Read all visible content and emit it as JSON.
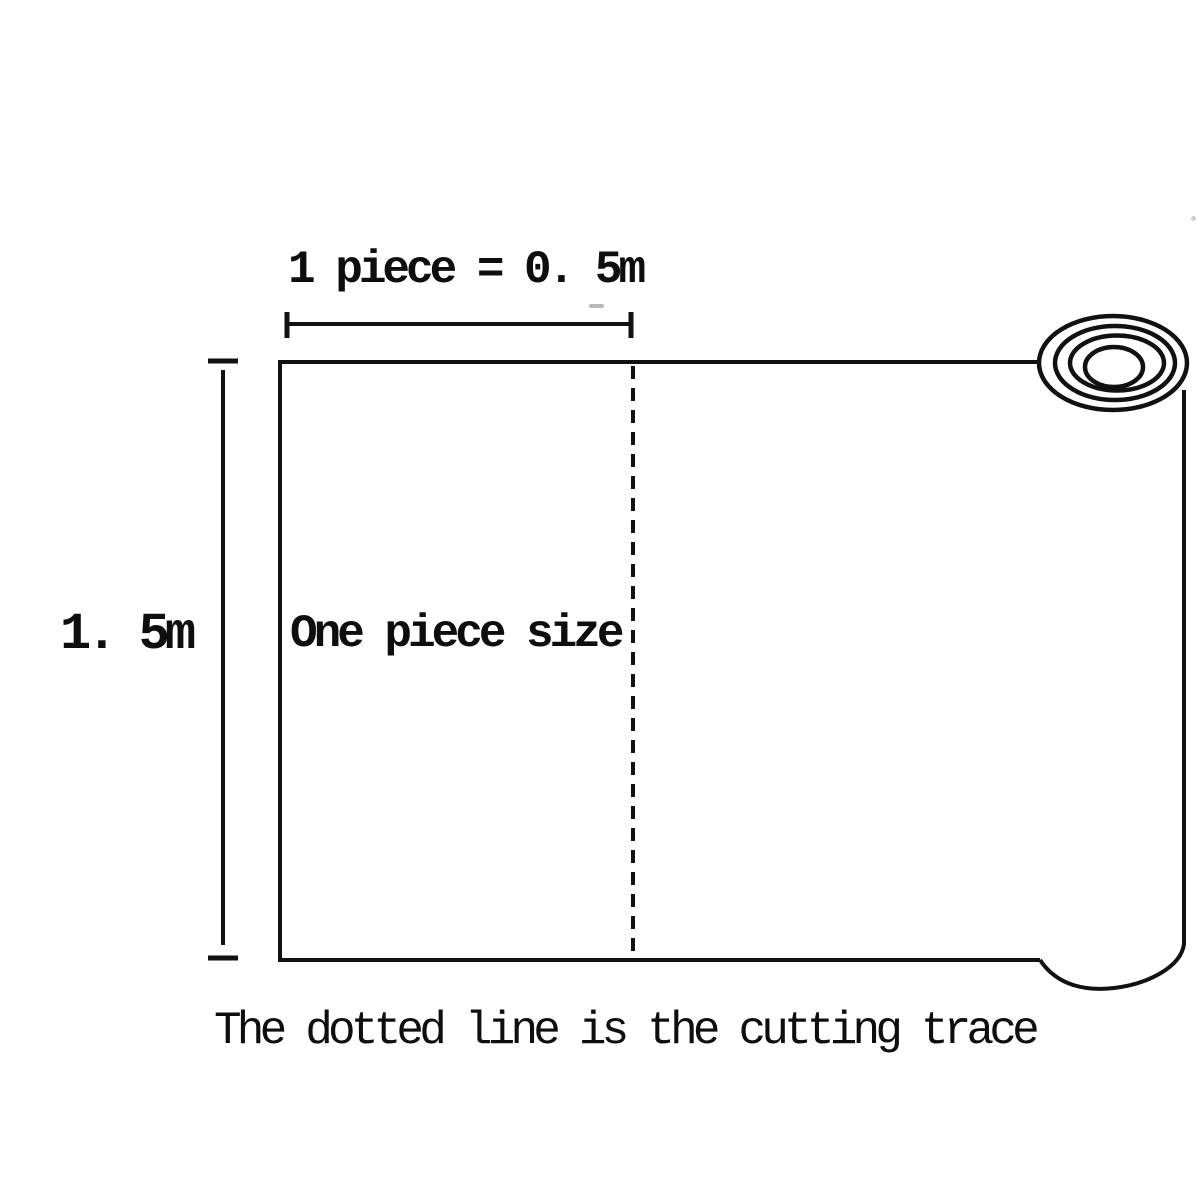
{
  "canvas": {
    "width": 1200,
    "height": 1200,
    "background_color": "#ffffff",
    "line_color": "#111111"
  },
  "diagram": {
    "title": "Fabric roll cutting size diagram",
    "top_dimension": {
      "label": "1 piece = 0. 5m",
      "measures": "width of one piece"
    },
    "left_dimension": {
      "label": "1. 5m",
      "measures": "height of the roll sheet"
    },
    "sheet": {
      "label": "One piece size"
    },
    "caption": "The dotted line is the cutting trace",
    "icons": {
      "roll": "rolled-material-icon",
      "cutting_line": "dashed-cutting-line"
    }
  }
}
